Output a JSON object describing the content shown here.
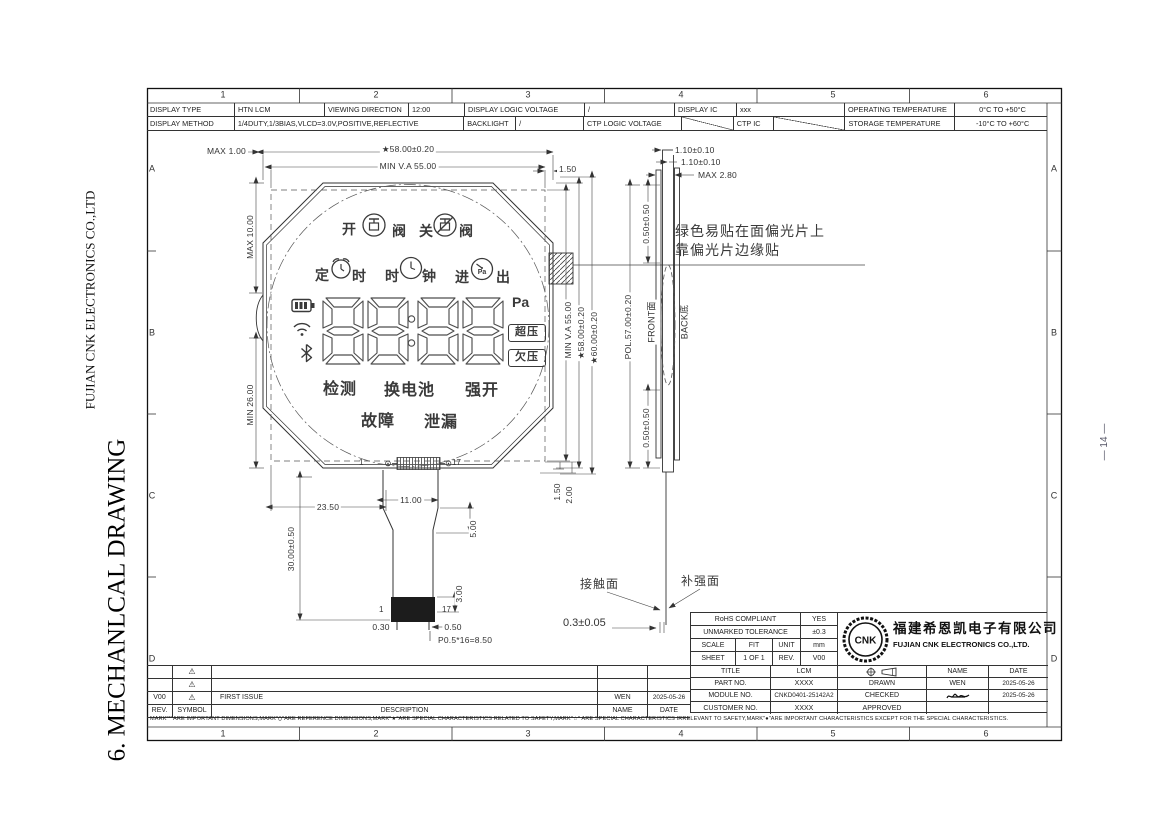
{
  "page": {
    "side_company": "FUJIAN CNK ELECTRONICS CO.,LTD",
    "side_title": "6. MECHANLCAL DRAWING",
    "page_number": "— 14 —"
  },
  "frame": {
    "cols": [
      "1",
      "2",
      "3",
      "4",
      "5",
      "6"
    ],
    "rows": [
      "A",
      "B",
      "C",
      "D"
    ]
  },
  "spec": {
    "r1": [
      "DISPLAY TYPE",
      "HTN  LCM",
      "VIEWING DIRECTION",
      "12:00",
      "DISPLAY LOGIC VOLTAGE",
      "/",
      "DISPLAY IC",
      "xxx",
      "OPERATING TEMPERATURE",
      "0°C TO +50°C"
    ],
    "r2": [
      "DISPLAY METHOD",
      "1/4DUTY,1/3BIAS,VLCD=3.0V,POSITIVE,REFLECTIVE",
      "BACKLIGHT",
      "/",
      "CTP LOGIC VOLTAGE",
      "",
      "CTP IC",
      "",
      "STORAGE TEMPERATURE",
      "-10°C TO +60°C"
    ]
  },
  "lcd": {
    "valve": [
      "开",
      "阀",
      "关",
      "阀"
    ],
    "timer": [
      "定",
      "时",
      "时",
      "钟",
      "进",
      "出"
    ],
    "digits": "8888",
    "unit": "Pa",
    "flags": [
      "超压",
      "欠压"
    ],
    "status": [
      "检测",
      "换电池",
      "强开"
    ],
    "fault": [
      "故障",
      "泄漏"
    ],
    "pin_first": "1",
    "pin_last": "17",
    "icons": [
      "valve-open",
      "valve-close",
      "alarm-clock",
      "clock",
      "pressure-gauge",
      "battery",
      "wifi",
      "bluetooth"
    ]
  },
  "dims": {
    "max_1": "MAX 1.00",
    "star58_top": "★58.00±0.20",
    "minva55_top": "MIN V.A 55.00",
    "d150_top": "1.50",
    "max10": "MAX 10.00",
    "min26": "MIN 26.00",
    "minva55_r": "MIN V.A 55.00",
    "star58_r": "★58.00±0.20",
    "star60_r": "★60.00±0.20",
    "d2350": "23.50",
    "d1100": "11.00",
    "d30": "30.00±0.50",
    "d500": "5.00",
    "d300": "3.00",
    "d030": "0.30",
    "d050": "0.50",
    "pitch": "P0.5*16=8.50",
    "d150_c": "1.50",
    "d200_c": "2.00",
    "t110a": "1.10±0.10",
    "t110b": "1.10±0.10",
    "max280": "MAX 2.80",
    "d05050_t": "0.50±0.50",
    "d05050_b": "0.50±0.50",
    "pol57": "POL.57.00±0.20",
    "front_face": "FRONT面",
    "back_face": "BACK底",
    "fpc_th": "0.3±0.05"
  },
  "ann": {
    "sticker1": "绿色易贴在面偏光片上",
    "sticker2": "靠偏光片边缘贴",
    "contact": "接触面",
    "stiffener": "补强面"
  },
  "tb": {
    "rohs_l": "RoHS COMPLIANT",
    "rohs_v": "YES",
    "tol_l": "UNMARKED TOLERANCE",
    "tol_v": "±0.3",
    "scale_l": "SCALE",
    "scale_v": "FIT",
    "unit_l": "UNIT",
    "unit_v": "mm",
    "sheet_l": "SHEET",
    "sheet_v": "1 OF 1",
    "rev_l": "REV.",
    "rev_v": "V00",
    "logo": "CNK",
    "co_cn": "福建希恩凯电子有限公司",
    "co_en": "FUJIAN CNK ELECTRONICS CO.,LTD.",
    "r": [
      {
        "c1": "TITLE",
        "c2": "LCM",
        "c3": "",
        "c4": "NAME",
        "c5": "DATE"
      },
      {
        "c1": "PART NO.",
        "c2": "XXXX",
        "c3": "DRAWN",
        "c4": "WEN",
        "c5": "2025-05-26"
      },
      {
        "c1": "MODULE NO.",
        "c2": "CNKD0401-25142A2",
        "c3": "CHECKED",
        "c4": "",
        "c5": "2025-05-26"
      },
      {
        "c1": "CUSTOMER NO.",
        "c2": "XXXX",
        "c3": "APPROVED",
        "c4": "",
        "c5": ""
      }
    ]
  },
  "rv": {
    "r0": {
      "rev": "",
      "sym": "⚠",
      "desc": "",
      "name": "",
      "date": ""
    },
    "r1": {
      "rev": "",
      "sym": "⚠",
      "desc": "",
      "name": "",
      "date": ""
    },
    "r2": {
      "rev": "V00",
      "sym": "⚠",
      "desc": "FIRST ISSUE",
      "name": "WEN",
      "date": "2025-05-26"
    },
    "r3": {
      "rev": "REV.",
      "sym": "SYMBOL",
      "desc": "DESCRIPTION",
      "name": "NAME",
      "date": "DATE"
    }
  },
  "note": {
    "text": "MARK\"*\"ARE IMPORTANT DIMENSIONS,MARK\"()\"ARE REFERENCE DIMENSIONS,MARK\"★\"ARE SPECIAL CHARACTERISTICS RELATED TO SAFETY,MARK\"☆\" ARE SPECIAL CHARACTERISTICS IRRELEVANT TO SAFETY,MARK\"●\"ARE IMPORTANT CHARACTERISTICS EXCEPT FOR THE SPECIAL CHARACTERISTICS."
  }
}
